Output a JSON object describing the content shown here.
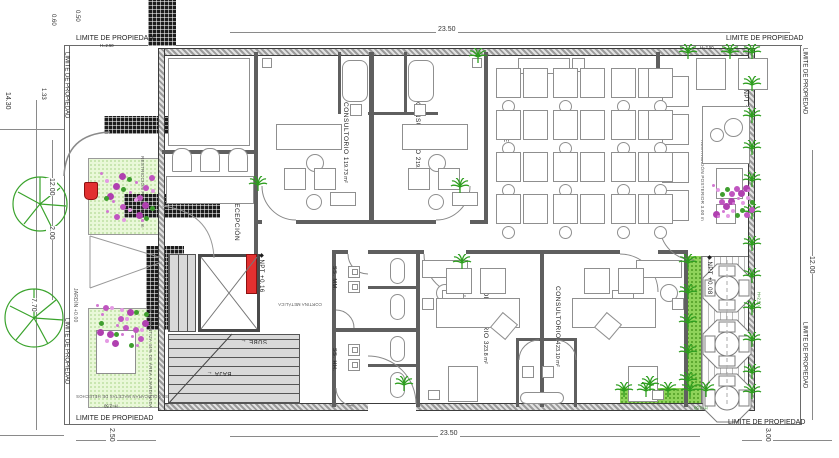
{
  "boundary": {
    "label": "LIMITE DE PROPIEDAD",
    "height_note": "H=2.50"
  },
  "dims": {
    "top": "23.50",
    "bottom": "23.50",
    "bottom_left": "2.50",
    "bottom_right": "3.00",
    "left_side": "12.00",
    "right_side": "12.00",
    "left_top_a": "0.50",
    "left_top_b": "0.60",
    "left_top_c": "1.33",
    "left_top_d": "14.30",
    "left_mid": "2.00",
    "left_bottom": "7.70"
  },
  "rooms": {
    "elevador": {
      "name": "ELEVADOR DE AUTOS"
    },
    "recepcion": {
      "name": "RECEPCIÓN"
    },
    "c1": {
      "name": "CONSULTORIO 1",
      "area": "19.73 m²"
    },
    "c2": {
      "name": "CONSULTORIO 2",
      "area": "19.73 m²"
    },
    "sala": {
      "name": "SALA DE ESPERA"
    },
    "ssmm": {
      "name": "SS. MM."
    },
    "sshh": {
      "name": "SS. HH."
    },
    "c3": {
      "name": "CONSULTORIO 3",
      "area": "23.8 m²"
    },
    "c4": {
      "name": "CONSULTORIO 4",
      "area": "23.10 m²"
    }
  },
  "levels": {
    "marker": "◆",
    "npt_main": "NPT +0.16",
    "npt_terrace": "NPT +0.08",
    "jardin": "JARDÍN +0.00"
  },
  "notes": {
    "restr_front": "RESTRICCIÓN FRONTAL 2.5 m",
    "restr_post": "RESTRICCIÓN POSTERIOR 3.00 m",
    "garden_note": "SE GARANTIZA 44% DE ÁREA AJARDINADA",
    "ferns_note": "SE COLOCARÁN MACETAS DE HELECHOS",
    "cortina": "CORTINA METÁLICA"
  },
  "stairs": {
    "up": "SUBE",
    "down": "BAJA",
    "arrow": "←"
  },
  "palette": {
    "wall": "#5f5f5f",
    "garden": "#e9f8d8",
    "plant": "#2e9e1f",
    "flower": "#d277d2",
    "accent_red": "#e23030",
    "accent_blue": "#1818cc"
  }
}
